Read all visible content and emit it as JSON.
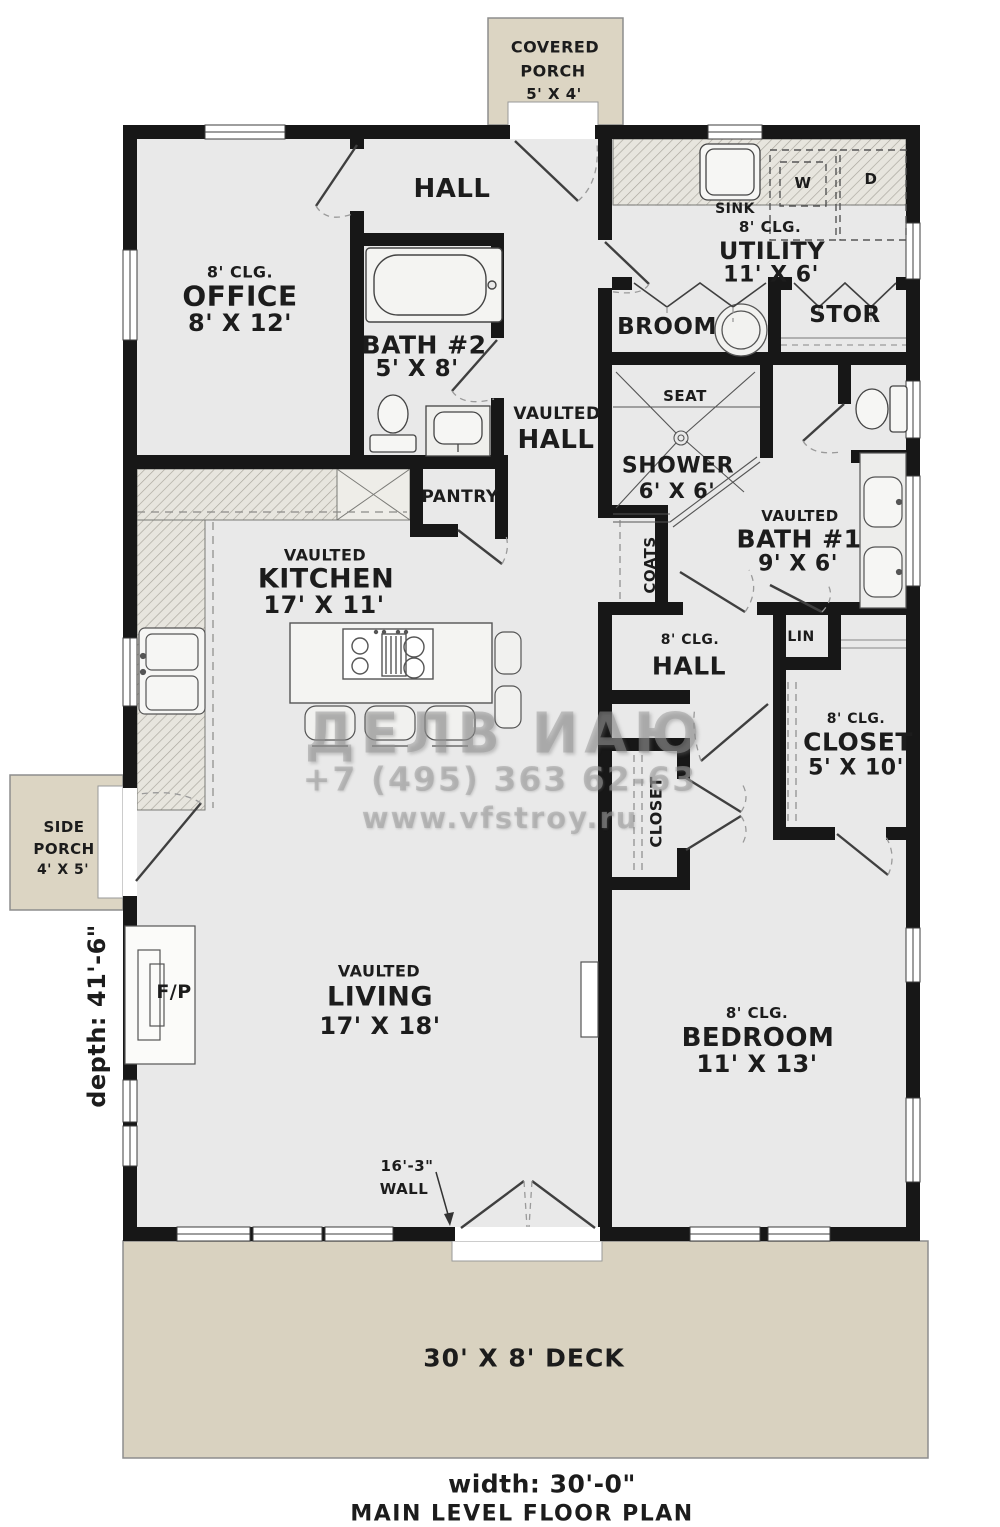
{
  "page": {
    "title": "MAIN LEVEL FLOOR PLAN",
    "width_label": "width: 30'-0\"",
    "depth_label": "depth: 41'-6\"",
    "wall_note": {
      "line1": "16'-3\"",
      "line2": "WALL"
    }
  },
  "outdoor": {
    "covered_porch": {
      "line1": "COVERED",
      "line2": "PORCH",
      "dims": "5' X 4'"
    },
    "side_porch": {
      "line1": "SIDE",
      "line2": "PORCH",
      "dims": "4' X 5'"
    },
    "deck": {
      "label": "30' X 8' DECK"
    }
  },
  "rooms": {
    "hall_top": {
      "name": "HALL"
    },
    "office": {
      "clg": "8' CLG.",
      "name": "OFFICE",
      "dims": "8' X 12'"
    },
    "bath2": {
      "name": "BATH #2",
      "dims": "5' X 8'"
    },
    "utility": {
      "clg": "8' CLG.",
      "name": "UTILITY",
      "dims": "11' X 6'"
    },
    "sink": {
      "name": "SINK"
    },
    "washer": {
      "name": "W"
    },
    "dryer": {
      "name": "D"
    },
    "broom": {
      "name": "BROOM"
    },
    "stor": {
      "name": "STOR"
    },
    "seat": {
      "name": "SEAT"
    },
    "shower": {
      "name": "SHOWER",
      "dims": "6' X 6'"
    },
    "vaulted_hall": {
      "line1": "VAULTED",
      "line2": "HALL"
    },
    "bath1": {
      "clg": "VAULTED",
      "name": "BATH #1",
      "dims": "9' X 6'"
    },
    "pantry": {
      "name": "PANTRY"
    },
    "kitchen": {
      "clg": "VAULTED",
      "name": "KITCHEN",
      "dims": "17' X 11'"
    },
    "coats": {
      "name": "COATS"
    },
    "hall_mid": {
      "clg": "8' CLG.",
      "name": "HALL"
    },
    "lin": {
      "name": "LIN"
    },
    "closet_main": {
      "clg": "8' CLG.",
      "name": "CLOSET",
      "dims": "5' X 10'"
    },
    "closet_bedroom": {
      "name": "CLOSET"
    },
    "living": {
      "clg": "VAULTED",
      "name": "LIVING",
      "dims": "17' X 18'"
    },
    "bedroom": {
      "clg": "8' CLG.",
      "name": "BEDROOM",
      "dims": "11' X 13'"
    },
    "fireplace": {
      "name": "F/P"
    }
  },
  "watermark": {
    "logo": "ДЕЛВ ИАЮ",
    "phone": "+7 (495) 363 62-63",
    "website": "www.vfstroy.ru"
  },
  "colors": {
    "wall": "#171717",
    "floor": "#e9e9e9",
    "porch_fill": "#dcd5c3",
    "deck_fill": "#d9d2c0",
    "watermark_gray": "#b4b4b4"
  }
}
